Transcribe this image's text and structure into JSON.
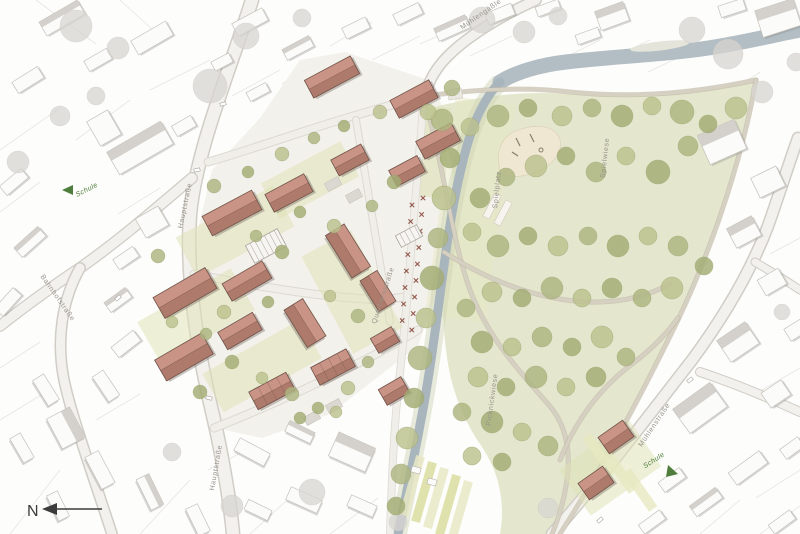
{
  "plan": {
    "labels": {
      "hauptstrasse_upper": "Hauptstraße",
      "hauptstrasse_lower": "Hauptstraße",
      "bahnhofstrasse": "Bahnhofstraße",
      "muehlengaessle": "Mühlengäßle",
      "muehlenstrasse": "Mühlenstraße",
      "quartiersstrasse": "Quartiersstraße",
      "spielplatz": "Spielplatz",
      "spielwiese": "Spielwiese",
      "picknickwiese": "Picknickwiese",
      "schule_west": "Schule",
      "schule_east": "Schule",
      "north_letter": "N"
    },
    "icons": {
      "north_arrow": "left-pointing-arrow",
      "schule_west_arrow": "green-direction-triangle",
      "schule_east_arrow": "green-direction-triangle"
    },
    "colors": {
      "background": "#fdfdfb",
      "existing_building": "#fbfbf9",
      "existing_outline": "#c5c2bc",
      "existing_roof": "#cfccc6",
      "existing_shadow": "rgba(130,125,118,0.30)",
      "new_building_light": "#c99486",
      "new_building_dark": "#ad7a6b",
      "new_building_outline": "#6f5248",
      "street_fill": "#f3f1ed",
      "street_casing": "#d0cdc6",
      "inner_street_fill": "#f0eee8",
      "inner_street_casing": "#dcd9d2",
      "river": "#a9b5bd",
      "river_wide": "#aeb9c1",
      "river_fringe": "#ccd3b3",
      "meadow": "#e1e4c9",
      "meadow_tint": "#e5e7c3",
      "quarter_base": "#f2f0e9",
      "tree_green_1": "#aeb681",
      "tree_green_2": "#a3ad74",
      "tree_green_3": "#bcc28e",
      "tree_gray": "#d8d6d1",
      "path_top": "#d6d0c2",
      "path_casing": "#b8b09f",
      "garden": "#dde1b4",
      "allotment_a": "#e7e7c4",
      "allotment_b": "#d9dd9f",
      "sand": "#efe7d2",
      "label_gray": "#97938b",
      "wayfinding_green": "#4f7d3c",
      "orchard_red": "#8a4a3e",
      "north_arrow_color": "#3c3c3c",
      "parcel_line": "#e7e5e1"
    }
  }
}
